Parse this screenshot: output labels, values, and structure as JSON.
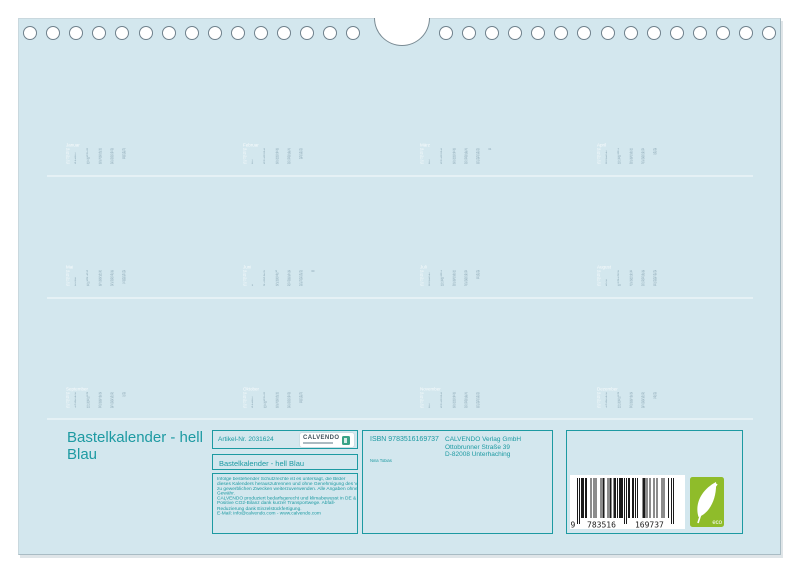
{
  "product": {
    "main_title": "Bastelkalender - hell Blau"
  },
  "info_panel": {
    "article_number": "Artikel-Nr. 2031624",
    "logo_text": "CALVENDO",
    "product_title": "Bastelkalender - hell Blau",
    "legal_lines": [
      "Infolge bestehender Schutzrechte ist es untersagt, die Bilder",
      "dieses Kalenders herauszutrennen und ohne Genehmigung des Verlages",
      "zu gewerblichen Zwecken weiterzuverwenden. Alle Angaben ohne",
      "Gewähr.",
      "CALVENDO produziert bedarfsgerecht und klimabewusst in DE & EU.",
      "Positive CO2-Bilanz dank kurzer Transportwege. Abfall-",
      "Reduzierung dank Einzelstückfertigung.",
      "E-Mail: info@calvendo.com - www.calvendo.com"
    ],
    "isbn": "ISBN 9783516169737",
    "author": "Nina Tobias",
    "publisher_lines": [
      "CALVENDO Verlag GmbH",
      "Ottobrunner Straße 39",
      "D-82008 Unterhaching"
    ],
    "barcode": {
      "value": "9783516169737",
      "system_digit": "9",
      "group_left": "783516",
      "group_right": "169737"
    },
    "eco_label": "eco"
  },
  "mini_calendars": {
    "weekday_labels": [
      "Mo",
      "Di",
      "Mi",
      "Do",
      "Fr",
      "Sa",
      "So"
    ],
    "months": [
      {
        "name": "Januar",
        "first_weekday": 2,
        "days": 31
      },
      {
        "name": "Februar",
        "first_weekday": 5,
        "days": 28
      },
      {
        "name": "März",
        "first_weekday": 5,
        "days": 31
      },
      {
        "name": "April",
        "first_weekday": 1,
        "days": 30
      },
      {
        "name": "Mai",
        "first_weekday": 3,
        "days": 31
      },
      {
        "name": "Juni",
        "first_weekday": 6,
        "days": 30
      },
      {
        "name": "Juli",
        "first_weekday": 1,
        "days": 31
      },
      {
        "name": "August",
        "first_weekday": 4,
        "days": 31
      },
      {
        "name": "September",
        "first_weekday": 0,
        "days": 30
      },
      {
        "name": "Oktober",
        "first_weekday": 2,
        "days": 31
      },
      {
        "name": "November",
        "first_weekday": 5,
        "days": 30
      },
      {
        "name": "Dezember",
        "first_weekday": 0,
        "days": 31
      }
    ]
  },
  "colors": {
    "page_bg": "#d3e7ee",
    "teal": "#1d9aa2",
    "eco_green": "#8fbc2a"
  }
}
